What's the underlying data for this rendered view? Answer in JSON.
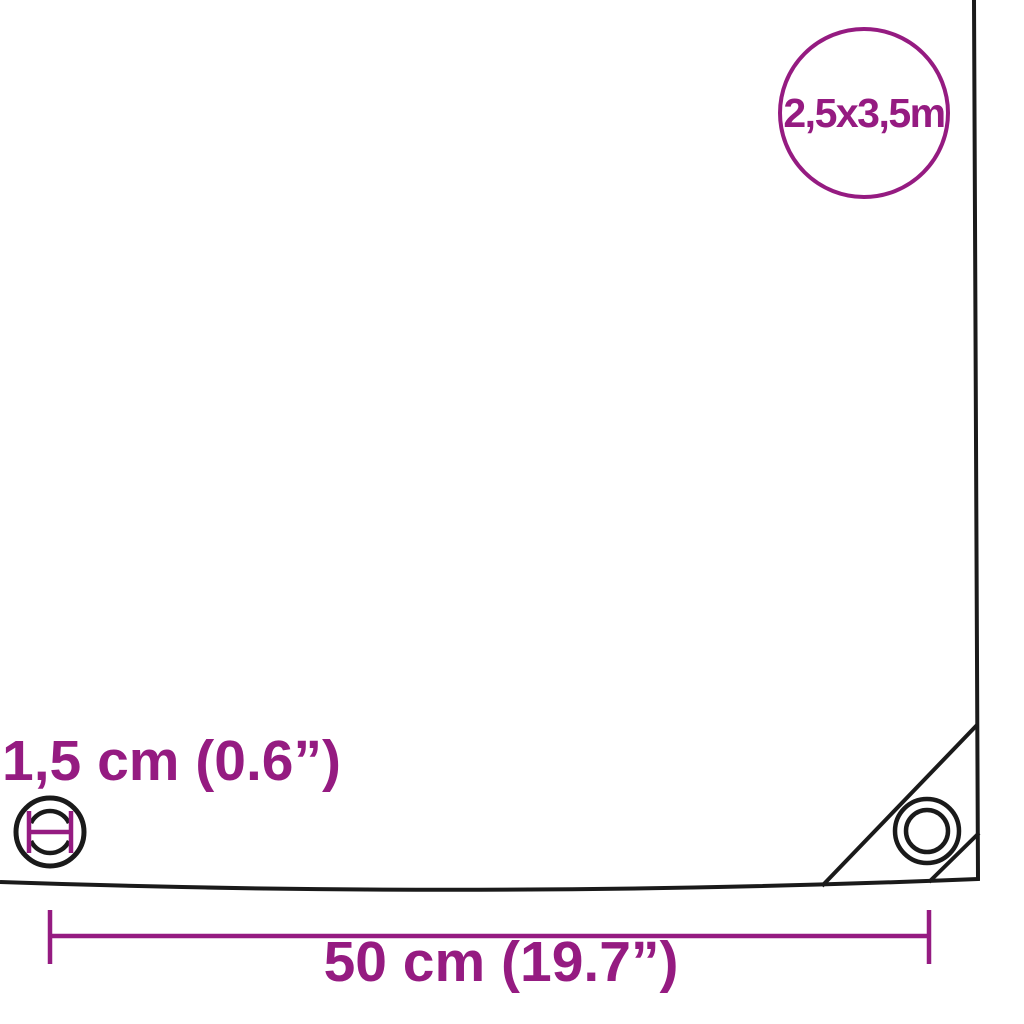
{
  "image": {
    "kind": "tarpaulin-dimension-diagram",
    "background": "#ffffff"
  },
  "colors": {
    "accent": "#951B81",
    "outline": "#1A1A1A",
    "fill": "#FFFFFF"
  },
  "size_badge": {
    "label": "2,5x3,5m"
  },
  "eyelet": {
    "diameter_label": "1,5 cm (0.6”)"
  },
  "edge_distance": {
    "label": "50 cm (19.7”)"
  },
  "icons": {
    "grommet_diameter_icon": "circle with inner ring and purple H-shaped diameter mark",
    "corner_grommet_icon": "double-circle eyelet",
    "corner_seam_icon": "diagonal reinforcement seams"
  }
}
